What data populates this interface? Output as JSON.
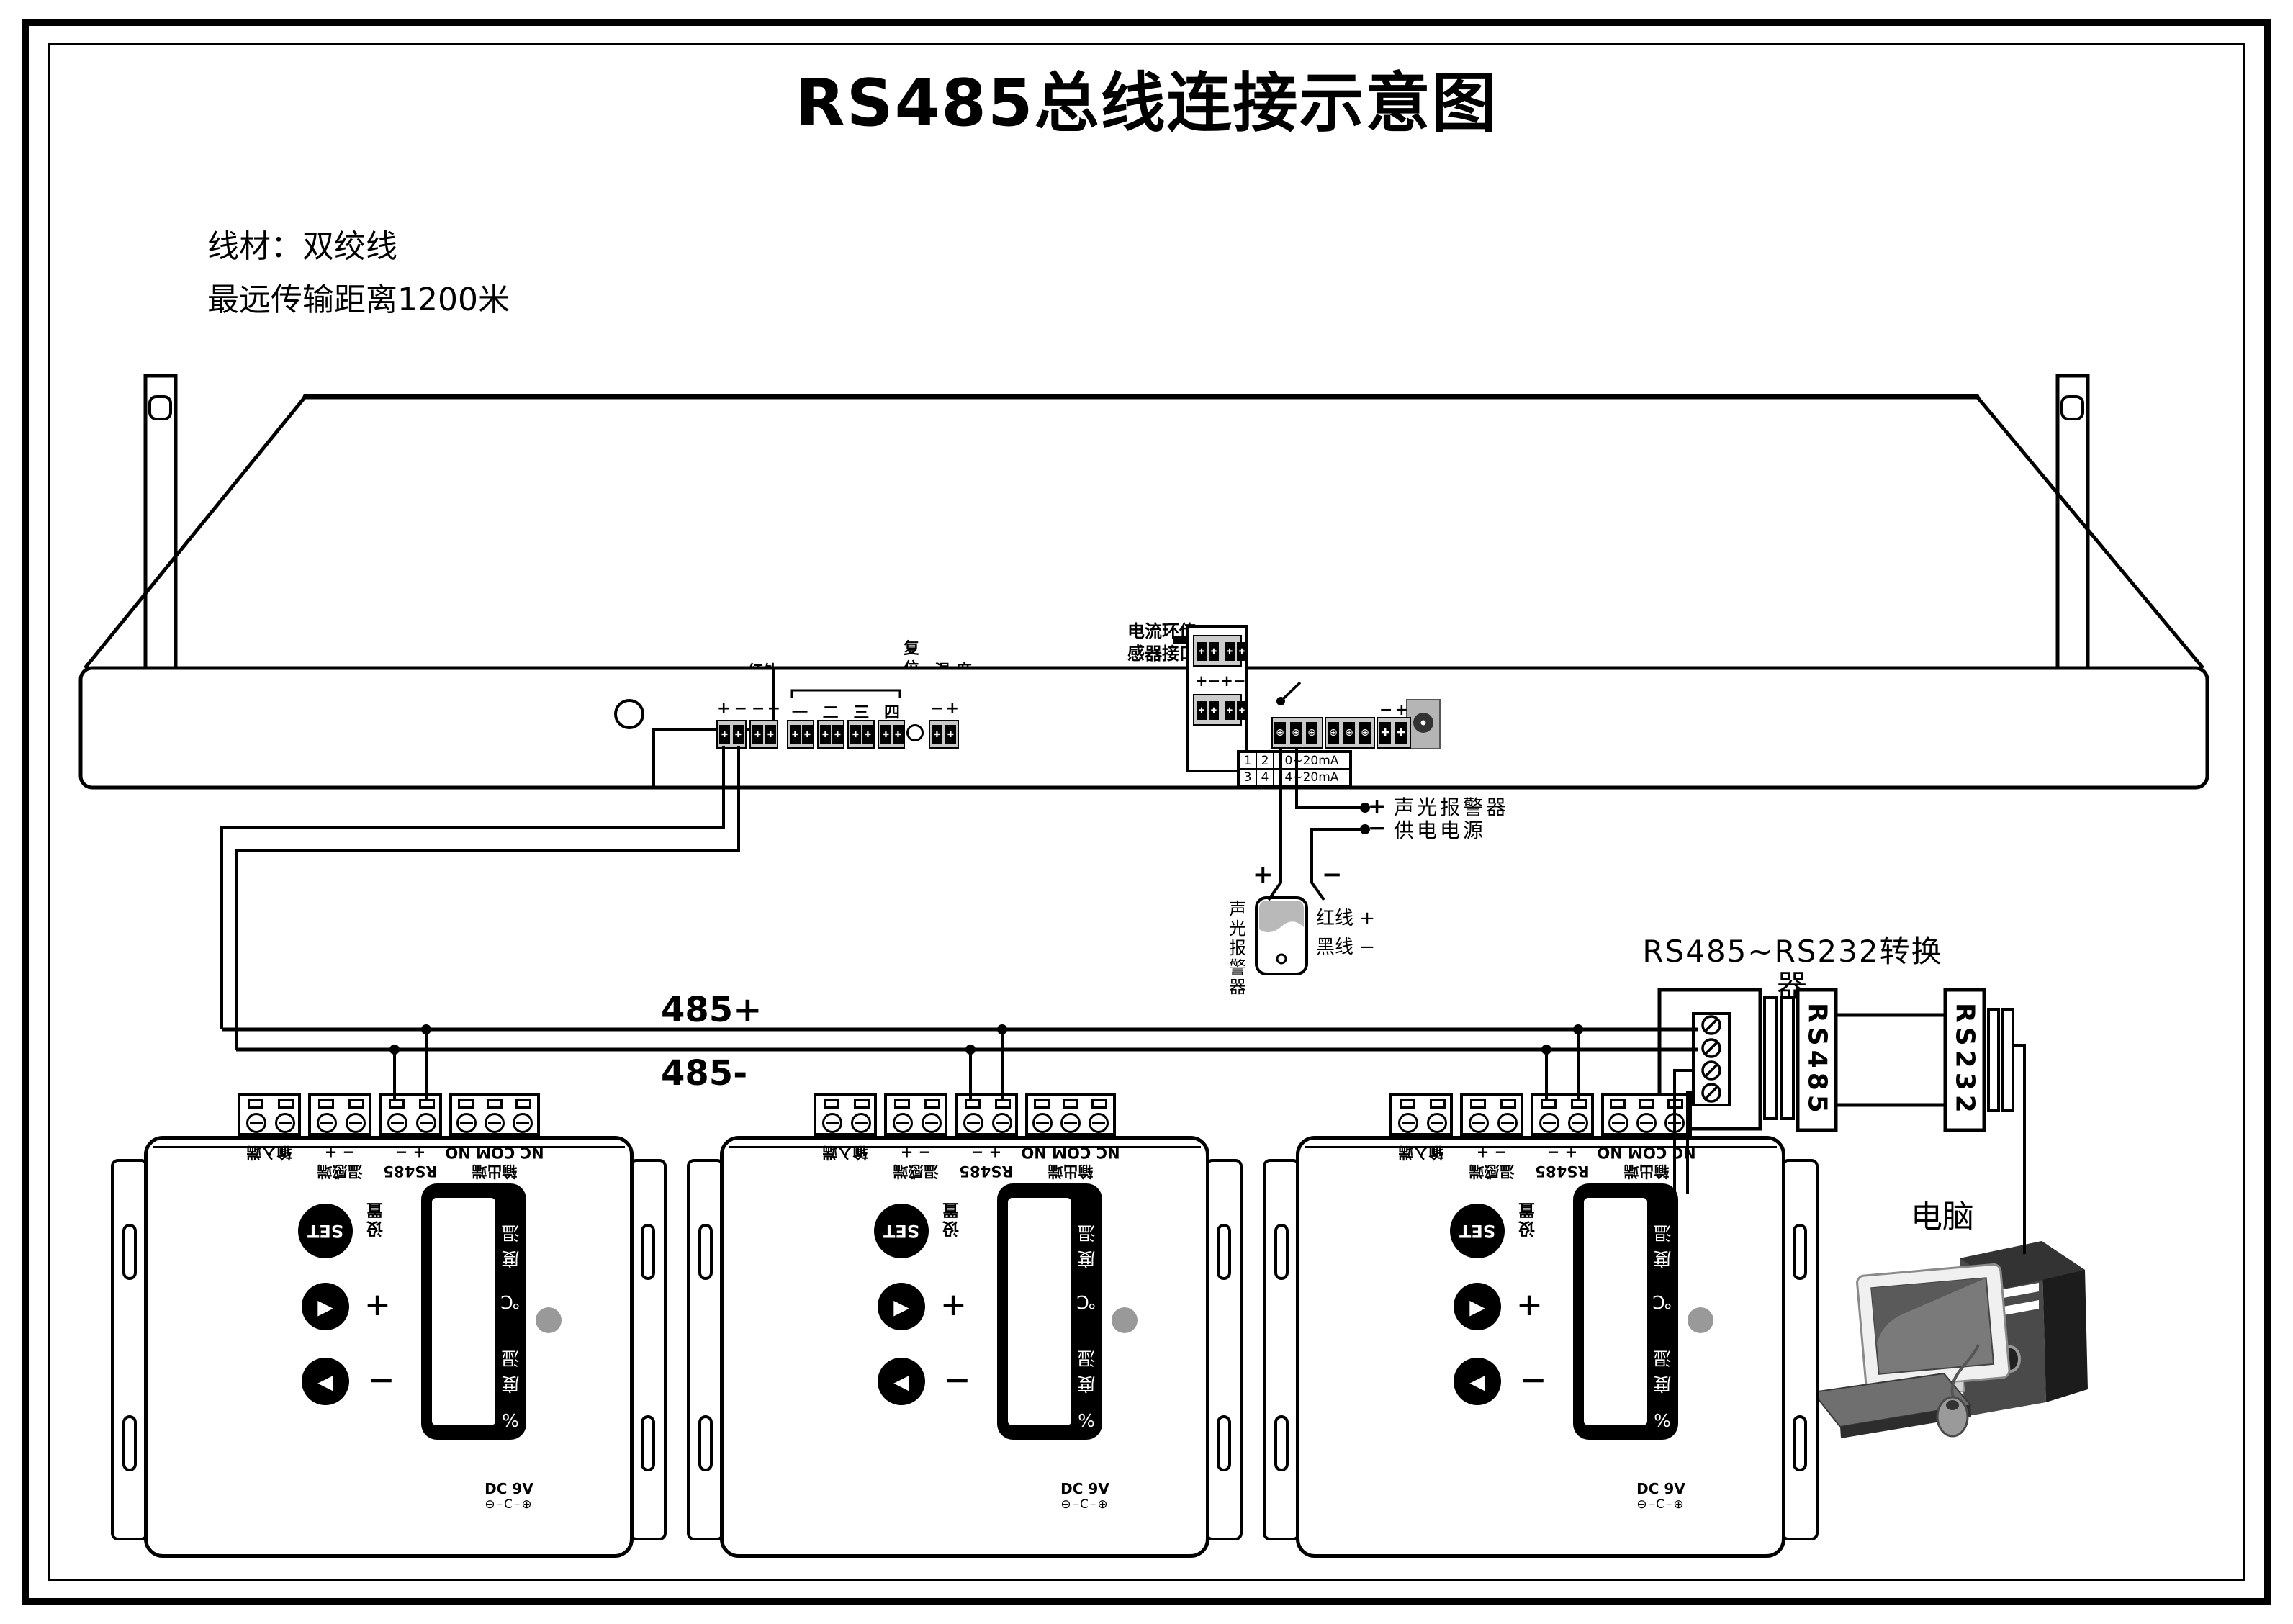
{
  "title": "RS485总线连接示意图",
  "notes": {
    "line1": "线材：双绞线",
    "line2": "最远传输距离1200米"
  },
  "icons": {
    "cross": "✚",
    "screw": "⊕",
    "tri_right": "▶",
    "tri_left": "◀",
    "polarity": "⊖–C–⊕"
  },
  "rack": {
    "antenna": "天线",
    "gsm": "GSM卡",
    "rs485": "RS485",
    "rs485_pins_l": "+",
    "rs485_pins_r": "−",
    "ir_tx": "红外\n发射",
    "ir_tx_pins_l": "−",
    "ir_tx_pins_r": "+",
    "sw_title": "开关量传感器输入",
    "sw_nums": [
      "一",
      "二",
      "三",
      "四"
    ],
    "reset": "复\n位\n键",
    "temp": "温 度\n传感器",
    "temp_pins_l": "−",
    "temp_pins_r": "+",
    "cl_label": "电流环传\n感器接口",
    "cl_pins": [
      "+",
      "−",
      "+",
      "−"
    ],
    "out1": "输出1",
    "out1_pins": "NO/COM/NC",
    "out2": "输出2",
    "out2_pins": "NO/COM/NC",
    "batt": "12V电瓶",
    "batt_pins_l": "−",
    "batt_pins_r": "+",
    "dc12v": "DC12V",
    "ir_rx": "红外\n接收",
    "humidity": "湿 度\n传感器",
    "ma": {
      "c11": "1",
      "c12": "2",
      "v1": "0~20mA",
      "c21": "3",
      "c22": "4",
      "v2": "4~20mA"
    }
  },
  "alarm": {
    "plus": "+",
    "minus": "−",
    "alarm_text": "声光报警器",
    "supply_text": "供电电源",
    "name": "声\n光\n报\n警\n器",
    "red": "红线 +",
    "black": "黑线 −"
  },
  "bus": {
    "plus": "485+",
    "minus": "485-"
  },
  "converter": {
    "title": "RS485~RS232转换器",
    "plus": "+",
    "minus": "−",
    "rs485": "RS485",
    "rs232": "RS232",
    "power": "5V~12V 电源"
  },
  "computer": {
    "label": "电脑"
  },
  "device": {
    "set": "SET",
    "set_lbl": "设\n置",
    "plus": "+",
    "minus": "−",
    "dc": "DC 9V",
    "plates": [
      {
        "name": "输入端",
        "sym": ""
      },
      {
        "name": "温感端",
        "sym": "− +"
      },
      {
        "name": "RS485",
        "sym": "+ −"
      },
      {
        "name": "输出端",
        "sym": "NC COM NO"
      }
    ],
    "lcd": [
      "温",
      "度",
      "℃",
      "湿",
      "度",
      "%"
    ]
  }
}
